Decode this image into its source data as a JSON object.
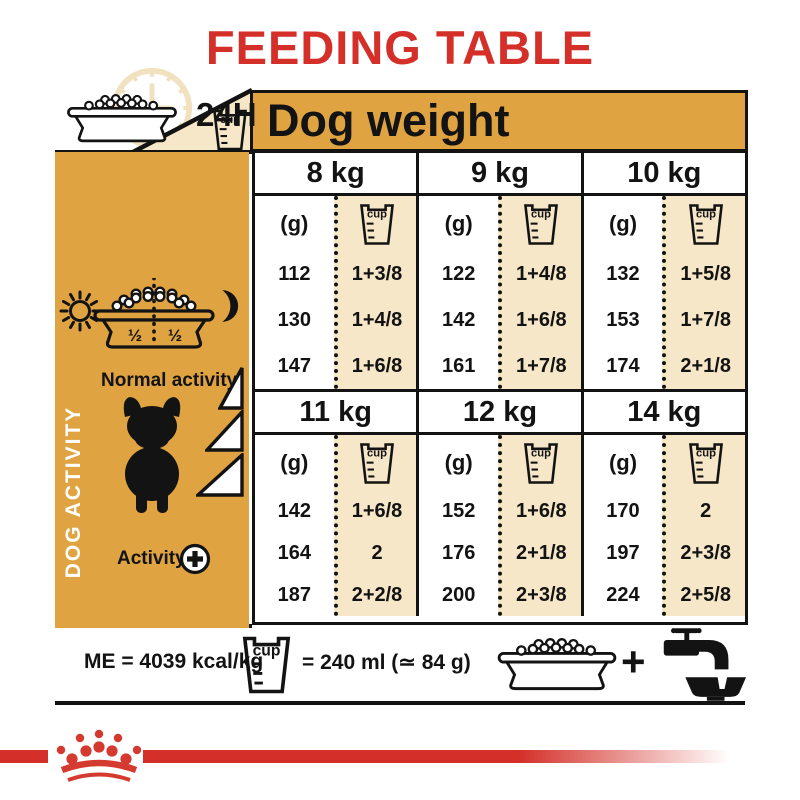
{
  "title": "FEEDING TABLE",
  "top": {
    "hours": "24H"
  },
  "icons": {
    "cup_label": "cup"
  },
  "table": {
    "header": "Dog weight",
    "grams_unit": "(g)",
    "banks": [
      {
        "columns": [
          {
            "weight": "8 kg",
            "grams": [
              "112",
              "130",
              "147"
            ],
            "cups": [
              "1+3/8",
              "1+4/8",
              "1+6/8"
            ]
          },
          {
            "weight": "9 kg",
            "grams": [
              "122",
              "142",
              "161"
            ],
            "cups": [
              "1+4/8",
              "1+6/8",
              "1+7/8"
            ]
          },
          {
            "weight": "10 kg",
            "grams": [
              "132",
              "153",
              "174"
            ],
            "cups": [
              "1+5/8",
              "1+7/8",
              "2+1/8"
            ]
          }
        ]
      },
      {
        "columns": [
          {
            "weight": "11 kg",
            "grams": [
              "142",
              "164",
              "187"
            ],
            "cups": [
              "1+6/8",
              "2",
              "2+2/8"
            ]
          },
          {
            "weight": "12 kg",
            "grams": [
              "152",
              "176",
              "200"
            ],
            "cups": [
              "1+6/8",
              "2+1/8",
              "2+3/8"
            ]
          },
          {
            "weight": "14 kg",
            "grams": [
              "170",
              "197",
              "224"
            ],
            "cups": [
              "2",
              "2+3/8",
              "2+5/8"
            ]
          }
        ]
      }
    ]
  },
  "sidebar": {
    "vertical_label": "DOG ACTIVITY",
    "bowl_left_half": "½",
    "bowl_right_half": "½",
    "normal_activity_label": "Normal activity",
    "activity_label": "Activity"
  },
  "footer": {
    "me_text": "ME = 4039 kcal/kg",
    "cup_equivalence": "= 240 ml (≃ 84 g)",
    "plus_sign": "+"
  },
  "colors": {
    "red": "#d42f28",
    "gold": "#dfa441",
    "cream": "#f7e7c9",
    "ink": "#131313"
  }
}
